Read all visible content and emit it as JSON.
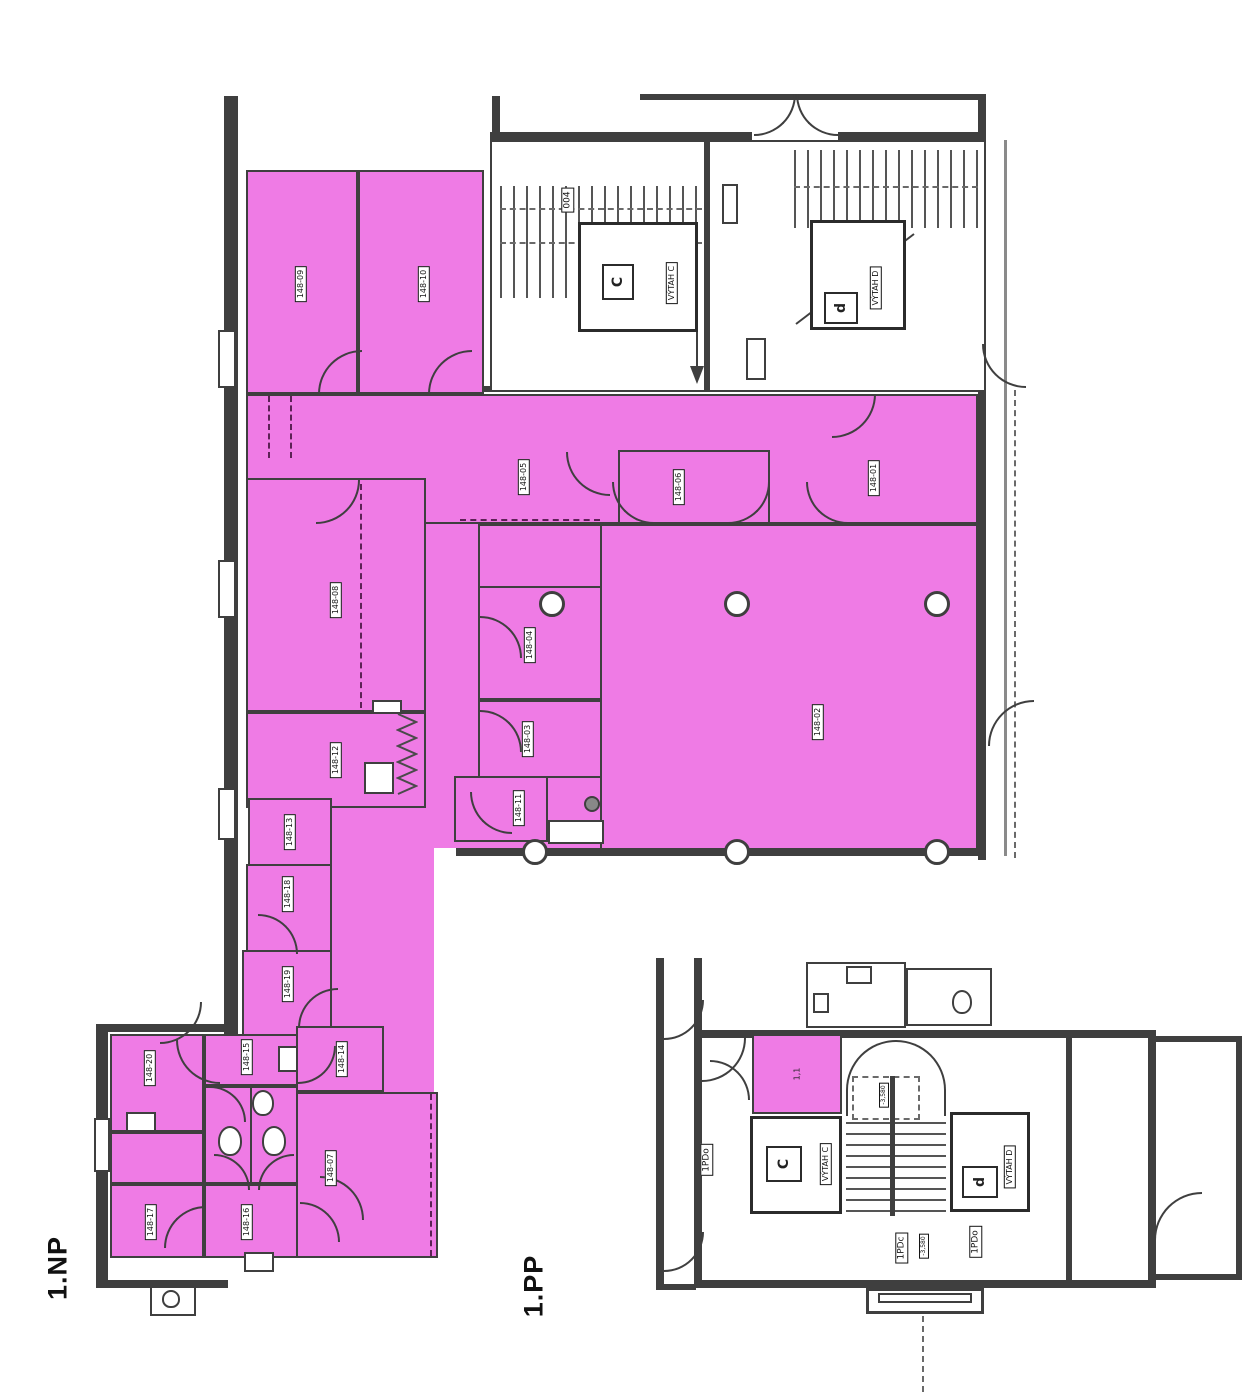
{
  "colors": {
    "highlight": "#EF7BE5",
    "wall": "#3F3F3F"
  },
  "np": {
    "title": "1.NP",
    "rooms": {
      "r01": "148-01",
      "r02": "148-02",
      "r03": "148-03",
      "r04": "148-04",
      "r05": "148-05",
      "r06": "148-06",
      "r07": "148-07",
      "r08": "148-08",
      "r09": "148-09",
      "r10": "148-10",
      "r11": "148-11",
      "r12": "148-12",
      "r13": "148-13",
      "r14": "148-14",
      "r15": "148-15",
      "r16": "148-16",
      "r17": "148-17",
      "r18": "148-18",
      "r19": "148-19",
      "r20": "148-20"
    },
    "stair": {
      "room_004": "004",
      "vytah_c": "VÝTAH C",
      "vytah_c_letter": "C",
      "vytah_d": "VÝTAH D",
      "vytah_d_letter": "d"
    }
  },
  "pp": {
    "title": "1.PP",
    "room_11": "1,1",
    "vytah_c": "VÝTAH C",
    "vytah_c_letter": "C",
    "vytah_d": "VÝTAH D",
    "vytah_d_letter": "d",
    "pdo_left": "1PDo",
    "pdc_bottom": "1PDc",
    "pdo_bottom": "1PDo",
    "level_top": "-3,580",
    "level_bottom": "-3,580"
  }
}
